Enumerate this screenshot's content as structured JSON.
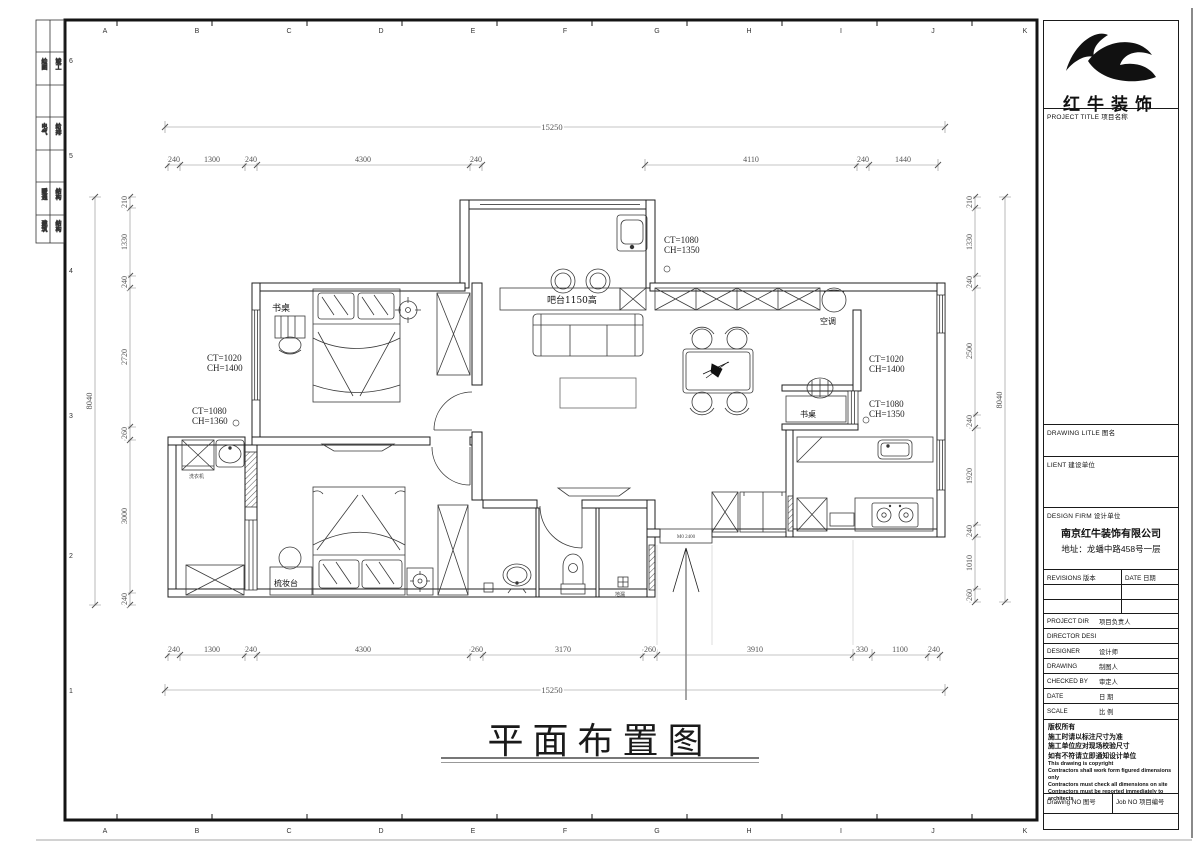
{
  "frame": {
    "top_letters": [
      "A",
      "B",
      "C",
      "D",
      "E",
      "F",
      "G",
      "H",
      "I",
      "J",
      "K"
    ],
    "side_numbers": [
      "6",
      "5",
      "4",
      "3",
      "2",
      "1"
    ],
    "margin_cells": [
      {
        "a": "绘图",
        "b": "竣工"
      },
      {
        "a": "电气",
        "b": "给排"
      },
      {
        "a": "暖通",
        "b": "结构"
      },
      {
        "a": "建筑",
        "b": "结构"
      }
    ]
  },
  "plan": {
    "main_title": "平面布置图",
    "labels": {
      "desk_bedroom": "书桌",
      "desk_study": "书桌",
      "bar": "吧台1150高",
      "ac": "空调",
      "dresser": "梳妆台",
      "washer": "洗衣机",
      "floor_drain": "地漏",
      "entry_mark": "M0 2400"
    },
    "window_tags": [
      {
        "line1": "CT=1020",
        "line2": "CH=1400"
      },
      {
        "line1": "CT=1080",
        "line2": "CH=1360"
      },
      {
        "line1": "CT=1080",
        "line2": "CH=1350"
      },
      {
        "line1": "CT=1020",
        "line2": "CH=1400"
      },
      {
        "line1": "CT=1080",
        "line2": "CH=1350"
      }
    ],
    "dimensions": {
      "top_total": "15250",
      "bottom_total": "15250",
      "left_total": "8040",
      "right_total": "8040",
      "top_row": [
        "240",
        "1300",
        "240",
        "4300",
        "240",
        "4110",
        "240",
        "1440"
      ],
      "bottom_row": [
        "240",
        "1300",
        "240",
        "4300",
        "260",
        "3170",
        "260",
        "3910",
        "330",
        "1100",
        "240"
      ],
      "left_col": [
        "210",
        "1330",
        "240",
        "2720",
        "260",
        "3000",
        "240"
      ],
      "right_col": [
        "210",
        "1330",
        "240",
        "2500",
        "240",
        "1920",
        "240",
        "1010",
        "260"
      ]
    }
  },
  "title_block": {
    "logo_text": "红牛装饰",
    "project_title_label": "PROJECT TITLE  项目名称",
    "drawing_title_label": "DRAWING LITLE  图名",
    "client_label": "LIENT  建设单位",
    "design_firm_label": "DESIGN FIRM  设计单位",
    "firm_name": "南京红牛装饰有限公司",
    "firm_address": "地址：龙蟠中路458号一层",
    "revisions_label": "REVISIONS  版本",
    "date_col_label": "DATE 日期",
    "rows": [
      {
        "en": "PROJECT DIR",
        "cn": "项目负责人"
      },
      {
        "en": "DIRECTOR DESI",
        "cn": ""
      },
      {
        "en": "DESIGNER",
        "cn": "设计师"
      },
      {
        "en": "DRAWING",
        "cn": "制图人"
      },
      {
        "en": "CHECKED BY",
        "cn": "审定人"
      },
      {
        "en": "DATE",
        "cn": "日  期"
      },
      {
        "en": "SCALE",
        "cn": "比  例"
      }
    ],
    "copyright_cn": [
      "版权所有",
      "施工时请以标注尺寸为准",
      "施工单位应对现场校验尺寸",
      "如有不符请立即通知设计单位"
    ],
    "copyright_en": [
      "This drawing is copyright",
      "Contractors shall work form figured dimensions only",
      "Contractors must check all dimensions on site",
      "Contractors must be reported immediately to architects"
    ],
    "drawing_no_label": "Drawing NO  图号",
    "job_no_label": "Job NO  项目编号"
  }
}
